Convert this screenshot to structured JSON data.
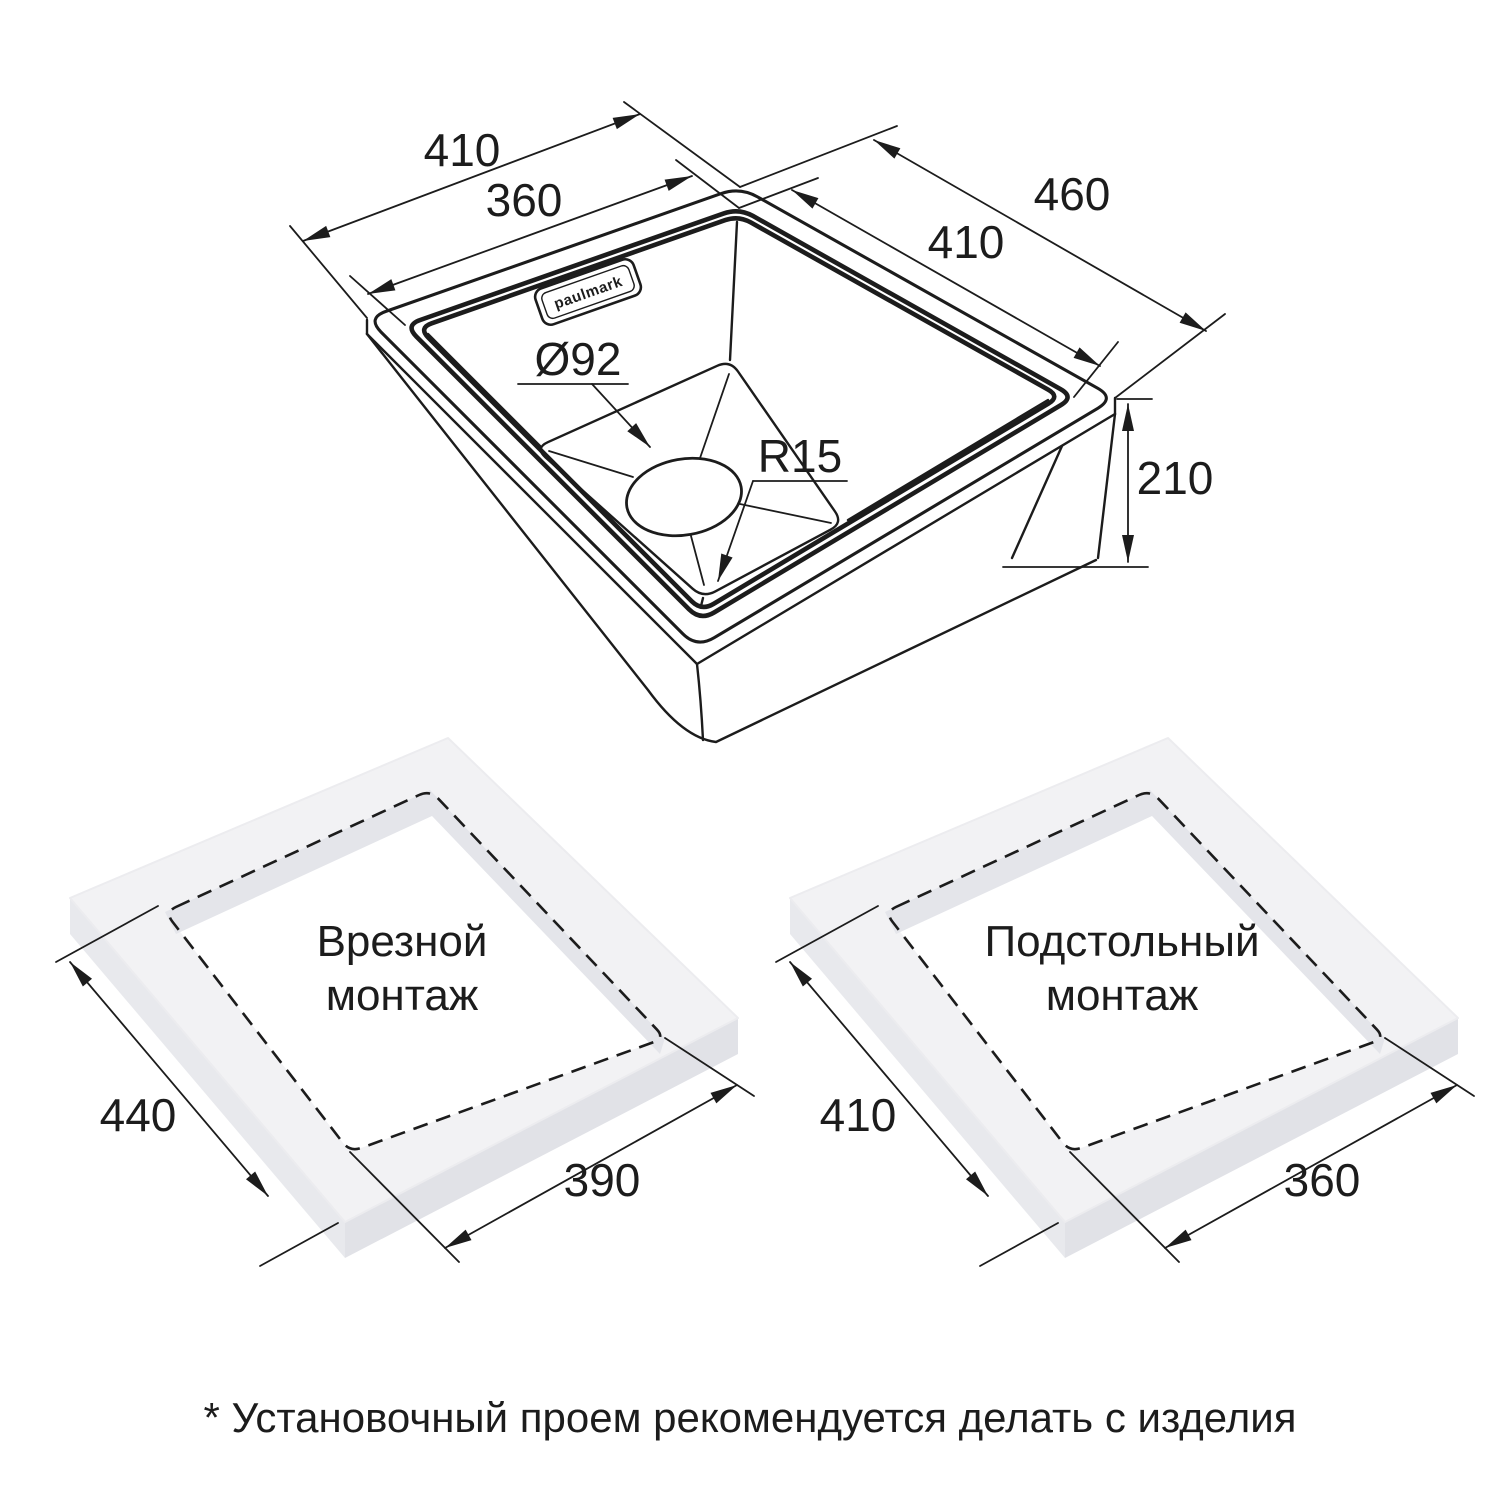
{
  "brand": {
    "logo_text": "paulmark"
  },
  "sink_view": {
    "dim_outer_width": "410",
    "dim_inner_width": "360",
    "dim_outer_depth": "460",
    "dim_inner_depth": "410",
    "drain_diameter_label": "Ø92",
    "corner_radius_label": "R15",
    "bowl_depth": "210"
  },
  "inset_mount": {
    "title_line1": "Врезной",
    "title_line2": "монтаж",
    "dim_side": "440",
    "dim_front": "390"
  },
  "under_mount": {
    "title_line1": "Подстольный",
    "title_line2": "монтаж",
    "dim_side": "410",
    "dim_front": "360"
  },
  "footnote": "* Установочный проем рекомендуется делать с изделия",
  "colors": {
    "line": "#1c1c1c",
    "slab_top": "#f2f2f4",
    "slab_side_left": "#e8e9ed",
    "slab_side_right": "#e1e2e7"
  }
}
